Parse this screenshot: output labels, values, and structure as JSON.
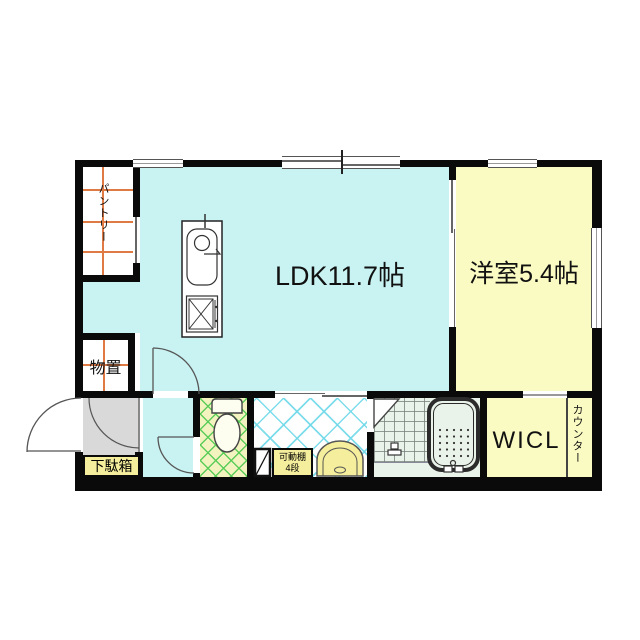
{
  "plan": {
    "type": "japanese-apartment-floor-plan",
    "labels": {
      "ldk": "LDK11.7帖",
      "western_room": "洋室5.4帖",
      "wicl": "WICL",
      "counter": "カウンター",
      "pantry": "パントリー",
      "storage": "物置",
      "shoe_cabinet": "下駄箱",
      "movable_shelf_line1": "可動棚",
      "movable_shelf_line2": "4段"
    },
    "colors": {
      "ldk_floor": "#c9f2f2",
      "western_room_floor": "#fafac3",
      "wicl_floor": "#fafac3",
      "toilet_floor": "#f3f3c0",
      "toilet_hatch": "#55cc55",
      "washroom_hatch": "#6fd9e9",
      "bathroom_floor": "#eaf3ea",
      "genkan_floor": "#d9d9d9",
      "cabinet_yellow": "#f5ee9c",
      "shelf_grid_orange": "#e07a45",
      "wall": "#0a0a0a"
    }
  }
}
